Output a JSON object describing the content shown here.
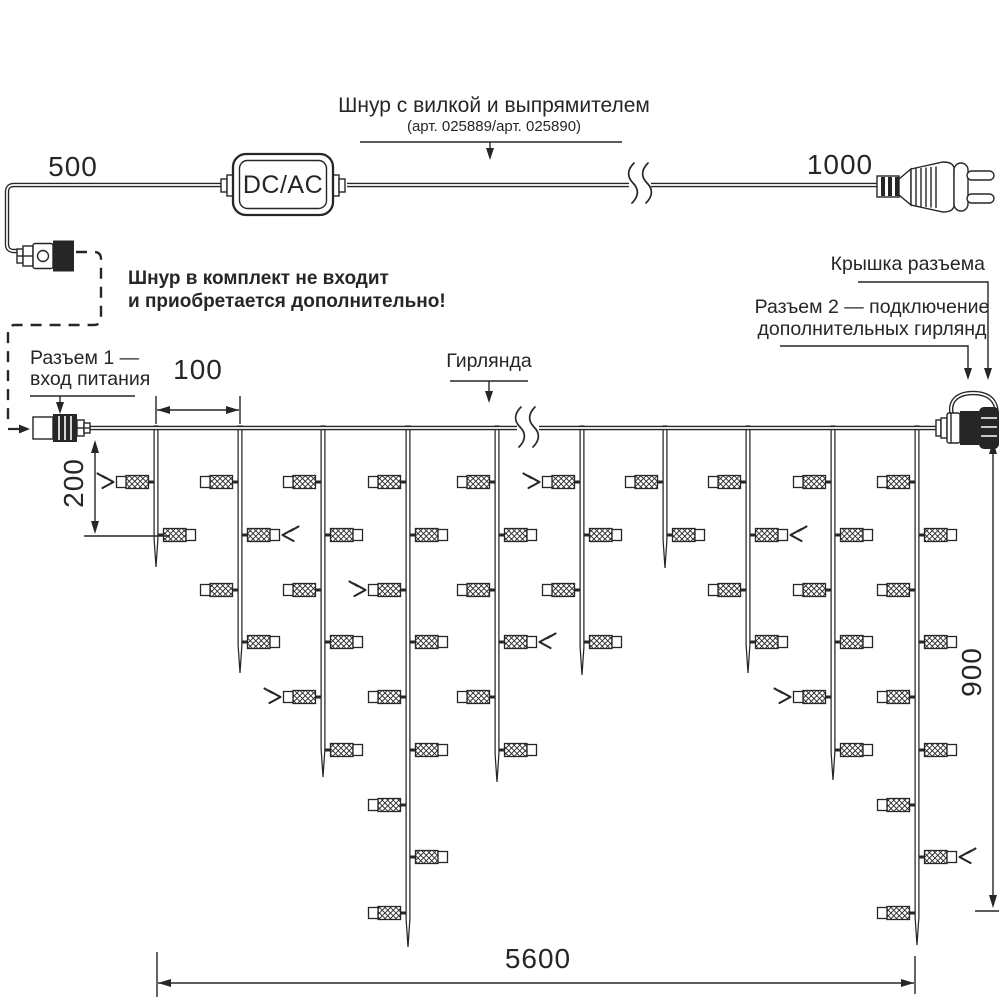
{
  "top": {
    "dim_left": "500",
    "dim_right": "1000",
    "box_label": "DC/AC",
    "cord_label": "Шнур с вилкой и выпрямителем",
    "cord_sublabel": "(арт. 025889/арт. 025890)",
    "note_line1": "Шнур в комплект не входит",
    "note_line2": "и приобретается дополнительно!"
  },
  "garland": {
    "connector1_label_line1": "Разъем 1 —",
    "connector1_label_line2": "вход питания",
    "garland_label": "Гирлянда",
    "cap_label": "Крышка разъема",
    "connector2_label_line1": "Разъем 2 — подключение",
    "connector2_label_line2": "дополнительных гирлянд",
    "dim_spacing": "100",
    "dim_offset": "200",
    "dim_height": "900",
    "dim_length": "5600",
    "line_y": 428,
    "x_start": 90,
    "x_end": 936,
    "break_x": 528,
    "drops": [
      {
        "x": 156,
        "tip": 567,
        "lamps": [
          {
            "y": 482,
            "side": "L",
            "flash": true
          },
          {
            "y": 535,
            "side": "R",
            "flash": false
          }
        ]
      },
      {
        "x": 240,
        "tip": 673,
        "lamps": [
          {
            "y": 482,
            "side": "L",
            "flash": false
          },
          {
            "y": 535,
            "side": "R",
            "flash": true
          },
          {
            "y": 590,
            "side": "L",
            "flash": false
          },
          {
            "y": 642,
            "side": "R",
            "flash": false
          }
        ]
      },
      {
        "x": 323,
        "tip": 777,
        "lamps": [
          {
            "y": 482,
            "side": "L",
            "flash": false
          },
          {
            "y": 535,
            "side": "R",
            "flash": false
          },
          {
            "y": 590,
            "side": "L",
            "flash": false
          },
          {
            "y": 642,
            "side": "R",
            "flash": false
          },
          {
            "y": 697,
            "side": "L",
            "flash": true
          },
          {
            "y": 750,
            "side": "R",
            "flash": false
          }
        ]
      },
      {
        "x": 408,
        "tip": 947,
        "lamps": [
          {
            "y": 482,
            "side": "L",
            "flash": false
          },
          {
            "y": 535,
            "side": "R",
            "flash": false
          },
          {
            "y": 590,
            "side": "L",
            "flash": true
          },
          {
            "y": 642,
            "side": "R",
            "flash": false
          },
          {
            "y": 697,
            "side": "L",
            "flash": false
          },
          {
            "y": 750,
            "side": "R",
            "flash": false
          },
          {
            "y": 805,
            "side": "L",
            "flash": false
          },
          {
            "y": 857,
            "side": "R",
            "flash": false
          },
          {
            "y": 913,
            "side": "L",
            "flash": false
          }
        ]
      },
      {
        "x": 497,
        "tip": 782,
        "lamps": [
          {
            "y": 482,
            "side": "L",
            "flash": false
          },
          {
            "y": 535,
            "side": "R",
            "flash": false
          },
          {
            "y": 590,
            "side": "L",
            "flash": false
          },
          {
            "y": 642,
            "side": "R",
            "flash": true
          },
          {
            "y": 697,
            "side": "L",
            "flash": false
          },
          {
            "y": 750,
            "side": "R",
            "flash": false
          }
        ]
      },
      {
        "x": 582,
        "tip": 675,
        "lamps": [
          {
            "y": 482,
            "side": "L",
            "flash": true
          },
          {
            "y": 535,
            "side": "R",
            "flash": false
          },
          {
            "y": 590,
            "side": "L",
            "flash": false
          },
          {
            "y": 642,
            "side": "R",
            "flash": false
          }
        ]
      },
      {
        "x": 665,
        "tip": 568,
        "lamps": [
          {
            "y": 482,
            "side": "L",
            "flash": false
          },
          {
            "y": 535,
            "side": "R",
            "flash": false
          }
        ]
      },
      {
        "x": 748,
        "tip": 673,
        "lamps": [
          {
            "y": 482,
            "side": "L",
            "flash": false
          },
          {
            "y": 535,
            "side": "R",
            "flash": true
          },
          {
            "y": 590,
            "side": "L",
            "flash": false
          },
          {
            "y": 642,
            "side": "R",
            "flash": false
          }
        ]
      },
      {
        "x": 833,
        "tip": 780,
        "lamps": [
          {
            "y": 482,
            "side": "L",
            "flash": false
          },
          {
            "y": 535,
            "side": "R",
            "flash": false
          },
          {
            "y": 590,
            "side": "L",
            "flash": false
          },
          {
            "y": 642,
            "side": "R",
            "flash": false
          },
          {
            "y": 697,
            "side": "L",
            "flash": true
          },
          {
            "y": 750,
            "side": "R",
            "flash": false
          }
        ]
      },
      {
        "x": 917,
        "tip": 945,
        "lamps": [
          {
            "y": 482,
            "side": "L",
            "flash": false
          },
          {
            "y": 535,
            "side": "R",
            "flash": false
          },
          {
            "y": 590,
            "side": "L",
            "flash": false
          },
          {
            "y": 642,
            "side": "R",
            "flash": false
          },
          {
            "y": 697,
            "side": "L",
            "flash": false
          },
          {
            "y": 750,
            "side": "R",
            "flash": false
          },
          {
            "y": 805,
            "side": "L",
            "flash": false
          },
          {
            "y": 857,
            "side": "R",
            "flash": true
          },
          {
            "y": 913,
            "side": "L",
            "flash": false
          }
        ]
      }
    ]
  },
  "colors": {
    "ink": "#262626",
    "background": "#ffffff"
  }
}
